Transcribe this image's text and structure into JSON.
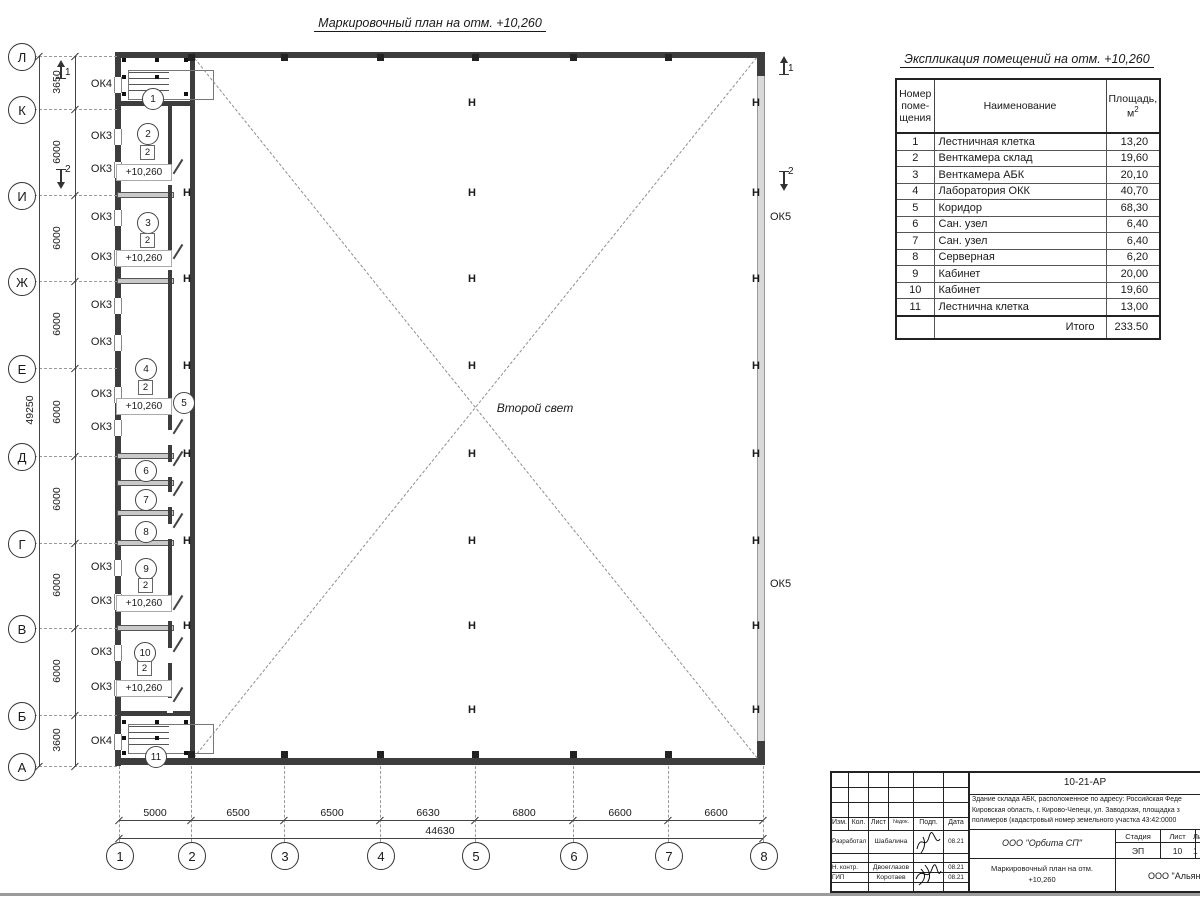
{
  "sheet": {
    "plan_title": "Маркировочный план на отм. +10,260",
    "second_light": "Второй свет"
  },
  "plan": {
    "rows": [
      {
        "label": "Л",
        "y": 56
      },
      {
        "label": "К",
        "y": 109
      },
      {
        "label": "И",
        "y": 195
      },
      {
        "label": "Ж",
        "y": 281
      },
      {
        "label": "Е",
        "y": 368
      },
      {
        "label": "Д",
        "y": 456
      },
      {
        "label": "Г",
        "y": 543
      },
      {
        "label": "В",
        "y": 628
      },
      {
        "label": "Б",
        "y": 715
      },
      {
        "label": "А",
        "y": 766
      }
    ],
    "cols": [
      {
        "label": "1",
        "x": 119
      },
      {
        "label": "2",
        "x": 191
      },
      {
        "label": "3",
        "x": 284
      },
      {
        "label": "4",
        "x": 380
      },
      {
        "label": "5",
        "x": 475
      },
      {
        "label": "6",
        "x": 573
      },
      {
        "label": "7",
        "x": 668
      },
      {
        "label": "8",
        "x": 763
      }
    ],
    "dims_left": [
      {
        "v": "3650",
        "y": 82
      },
      {
        "v": "6000",
        "y": 152
      },
      {
        "v": "6000",
        "y": 238
      },
      {
        "v": "6000",
        "y": 324
      },
      {
        "v": "6000",
        "y": 412
      },
      {
        "v": "6000",
        "y": 499
      },
      {
        "v": "6000",
        "y": 585
      },
      {
        "v": "6000",
        "y": 671
      },
      {
        "v": "3600",
        "y": 740
      }
    ],
    "dims_bottom": [
      {
        "v": "5000",
        "x": 155
      },
      {
        "v": "6500",
        "x": 238
      },
      {
        "v": "6500",
        "x": 332
      },
      {
        "v": "6630",
        "x": 428
      },
      {
        "v": "6800",
        "x": 524
      },
      {
        "v": "6600",
        "x": 620
      },
      {
        "v": "6600",
        "x": 716
      }
    ],
    "total_left": "49250",
    "total_bottom": "44630",
    "window_labels": [
      {
        "t": "ОК4",
        "y": 85
      },
      {
        "t": "ОК3",
        "y": 137
      },
      {
        "t": "ОК3",
        "y": 170
      },
      {
        "t": "ОК3",
        "y": 218
      },
      {
        "t": "ОК3",
        "y": 258
      },
      {
        "t": "ОК3",
        "y": 306
      },
      {
        "t": "ОК3",
        "y": 343
      },
      {
        "t": "ОК3",
        "y": 395
      },
      {
        "t": "ОК3",
        "y": 428
      },
      {
        "t": "ОК3",
        "y": 568
      },
      {
        "t": "ОК3",
        "y": 602
      },
      {
        "t": "ОК3",
        "y": 653
      },
      {
        "t": "ОК3",
        "y": 688
      },
      {
        "t": "ОК4",
        "y": 742
      }
    ],
    "ok5_labels": [
      {
        "t": "ОК5",
        "y": 218
      },
      {
        "t": "ОК5",
        "y": 585
      }
    ],
    "room_circles": [
      {
        "n": "1",
        "x": 152,
        "y": 98
      },
      {
        "n": "2",
        "x": 147,
        "y": 133
      },
      {
        "n": "3",
        "x": 147,
        "y": 222
      },
      {
        "n": "4",
        "x": 145,
        "y": 368
      },
      {
        "n": "5",
        "x": 183,
        "y": 402
      },
      {
        "n": "6",
        "x": 145,
        "y": 470
      },
      {
        "n": "7",
        "x": 145,
        "y": 499
      },
      {
        "n": "8",
        "x": 145,
        "y": 531
      },
      {
        "n": "9",
        "x": 145,
        "y": 568
      },
      {
        "n": "10",
        "x": 144,
        "y": 652
      },
      {
        "n": "11",
        "x": 155,
        "y": 756
      }
    ],
    "type_marks": [
      {
        "t": "2",
        "x": 147,
        "y": 152
      },
      {
        "t": "2",
        "x": 147,
        "y": 240
      },
      {
        "t": "2",
        "x": 145,
        "y": 387
      },
      {
        "t": "2",
        "x": 145,
        "y": 585
      },
      {
        "t": "2",
        "x": 144,
        "y": 668
      }
    ],
    "elevations": [
      {
        "t": "+10,260",
        "x": 143,
        "y": 172
      },
      {
        "t": "+10,260",
        "x": 143,
        "y": 258
      },
      {
        "t": "+10,260",
        "x": 143,
        "y": 406
      },
      {
        "t": "+10,260",
        "x": 143,
        "y": 603
      },
      {
        "t": "+10,260",
        "x": 143,
        "y": 688
      }
    ],
    "h_columns": [
      {
        "x": 473,
        "ys": [
          105,
          195,
          281,
          368,
          456,
          543,
          628,
          712
        ]
      },
      {
        "x": 757,
        "ys": [
          105,
          195,
          281,
          368,
          456,
          543,
          628,
          712
        ]
      },
      {
        "x": 188,
        "ys": [
          195,
          281,
          368,
          456,
          543,
          628
        ]
      }
    ],
    "section_marks": [
      {
        "n": "1",
        "x": 60,
        "y": 66,
        "dir": "up"
      },
      {
        "n": "2",
        "x": 60,
        "y": 170,
        "dir": "down"
      },
      {
        "n": "1",
        "x": 783,
        "y": 62,
        "dir": "up"
      },
      {
        "n": "2",
        "x": 783,
        "y": 172,
        "dir": "down"
      }
    ],
    "interior_walls_y": [
      195,
      281,
      456,
      483,
      513,
      543,
      628
    ],
    "stair_walls_y": [
      103,
      713
    ],
    "doors_y": [
      170,
      255,
      430,
      462,
      492,
      524,
      606,
      648,
      698
    ],
    "wall_squares_x": [
      191,
      284,
      380,
      475,
      573,
      668
    ],
    "column_dots": [
      [
        124,
        60
      ],
      [
        157,
        60
      ],
      [
        186,
        60
      ],
      [
        124,
        77
      ],
      [
        157,
        77
      ],
      [
        124,
        94
      ],
      [
        157,
        94
      ],
      [
        186,
        94
      ],
      [
        124,
        722
      ],
      [
        157,
        722
      ],
      [
        186,
        722
      ],
      [
        124,
        738
      ],
      [
        157,
        738
      ],
      [
        124,
        753
      ],
      [
        157,
        753
      ],
      [
        186,
        753
      ]
    ]
  },
  "room_table": {
    "title": "Экспликация помещений на отм. +10,260",
    "headers": [
      "Номер\nпоме-\nщения",
      "Наименование",
      "Площадь,\nм²"
    ],
    "rows": [
      [
        "1",
        "Лестничная клетка",
        "13,20"
      ],
      [
        "2",
        "Венткамера склад",
        "19,60"
      ],
      [
        "3",
        "Венткамера АБК",
        "20,10"
      ],
      [
        "4",
        "Лаборатория ОКК",
        "40,70"
      ],
      [
        "5",
        "Коридор",
        "68,30"
      ],
      [
        "6",
        "Сан. узел",
        "6,40"
      ],
      [
        "7",
        "Сан. узел",
        "6,40"
      ],
      [
        "8",
        "Серверная",
        "6,20"
      ],
      [
        "9",
        "Кабинет",
        "20,00"
      ],
      [
        "10",
        "Кабинет",
        "19,60"
      ],
      [
        "11",
        "Лестнична клетка",
        "13,00"
      ]
    ],
    "total_label": "Итого",
    "total_value": "233.50"
  },
  "title_block": {
    "doc_number": "10-21-АР",
    "address_lines": [
      "Здание склада АБК, расположенное по адресу: Российская Феде",
      "Кировская область, г. Кирово-Чепецк, ул. Заводская, площадка з",
      "полимеров (кадастровый номер земельного участка 43:42:0000"
    ],
    "grid_headers": [
      "Изм.",
      "Кол.",
      "Лист",
      "№док.",
      "Подп.",
      "Дата"
    ],
    "rows": [
      {
        "role": "Разработал",
        "name": "Шабалина",
        "date": "08.21"
      },
      {
        "role": "Н. контр.",
        "name": "Двоеглазов",
        "date": "08.21"
      },
      {
        "role": "ГИП",
        "name": "Коротаев",
        "date": "08.21"
      }
    ],
    "org1": "ООО \"Орбита СП\"",
    "stage_headers": [
      "Стадия",
      "Лист",
      "Листов"
    ],
    "stage_values": [
      "ЭП",
      "10",
      "1"
    ],
    "sheet_title_lines": [
      "Маркировочный план на отм.",
      "+10,260"
    ],
    "org2": "ООО \"Альянс"
  }
}
